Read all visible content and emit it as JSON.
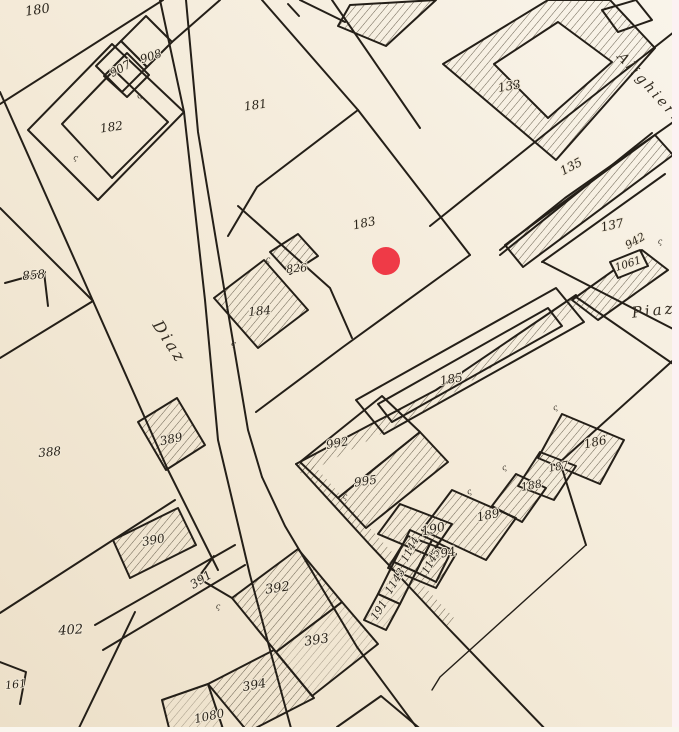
{
  "map": {
    "background": "#f2e9d7",
    "ink": "#241f18",
    "hatch_color": "#5a5140",
    "photo_edge_right_color": "#fcf2f3",
    "photo_edge_bottom_color": "#faf6ee",
    "marker": {
      "x": 386,
      "y": 261,
      "r": 14,
      "color": "#ef3a47"
    },
    "street_labels": [
      {
        "id": "diaz",
        "text": "Diaz",
        "x": 165,
        "y": 345,
        "rotation": 57,
        "size": 16
      },
      {
        "id": "alighieri",
        "text": "Alighieri",
        "x": 646,
        "y": 90,
        "rotation": 48,
        "size": 14
      },
      {
        "id": "piazza",
        "text": "Piaz.",
        "x": 658,
        "y": 315,
        "rotation": -6,
        "size": 15
      }
    ],
    "parcel_labels": [
      {
        "text": "180",
        "x": 38,
        "y": 14,
        "rotation": -8,
        "size": 13
      },
      {
        "text": "907",
        "x": 122,
        "y": 72,
        "rotation": -28,
        "size": 11.5
      },
      {
        "text": "908",
        "x": 152,
        "y": 60,
        "rotation": -18,
        "size": 11.5
      },
      {
        "text": "182",
        "x": 112,
        "y": 131,
        "rotation": -8,
        "size": 12
      },
      {
        "text": "181",
        "x": 256,
        "y": 109,
        "rotation": -8,
        "size": 12
      },
      {
        "text": "133",
        "x": 510,
        "y": 90,
        "rotation": -10,
        "size": 12
      },
      {
        "text": "135",
        "x": 573,
        "y": 170,
        "rotation": -28,
        "size": 12
      },
      {
        "text": "137",
        "x": 613,
        "y": 229,
        "rotation": -12,
        "size": 12
      },
      {
        "text": "942",
        "x": 637,
        "y": 244,
        "rotation": -30,
        "size": 11
      },
      {
        "text": "1061",
        "x": 629,
        "y": 267,
        "rotation": -18,
        "size": 10.5
      },
      {
        "text": "183",
        "x": 365,
        "y": 227,
        "rotation": -12,
        "size": 12
      },
      {
        "text": "826",
        "x": 297,
        "y": 272,
        "rotation": -5,
        "size": 11
      },
      {
        "text": "184",
        "x": 260,
        "y": 315,
        "rotation": -5,
        "size": 12
      },
      {
        "text": "858",
        "x": 34,
        "y": 279,
        "rotation": -5,
        "size": 12
      },
      {
        "text": "388",
        "x": 50,
        "y": 456,
        "rotation": -5,
        "size": 12
      },
      {
        "text": "389",
        "x": 172,
        "y": 443,
        "rotation": -12,
        "size": 12
      },
      {
        "text": "185",
        "x": 452,
        "y": 383,
        "rotation": -10,
        "size": 12
      },
      {
        "text": "992",
        "x": 338,
        "y": 447,
        "rotation": -10,
        "size": 12
      },
      {
        "text": "995",
        "x": 366,
        "y": 485,
        "rotation": -8,
        "size": 12
      },
      {
        "text": "186",
        "x": 596,
        "y": 446,
        "rotation": -12,
        "size": 12
      },
      {
        "text": "187",
        "x": 559,
        "y": 470,
        "rotation": -10,
        "size": 10.5
      },
      {
        "text": "188",
        "x": 532,
        "y": 489,
        "rotation": -10,
        "size": 11
      },
      {
        "text": "189",
        "x": 489,
        "y": 519,
        "rotation": -12,
        "size": 12
      },
      {
        "text": "190",
        "x": 434,
        "y": 533,
        "rotation": -12,
        "size": 12.5
      },
      {
        "text": "994",
        "x": 445,
        "y": 557,
        "rotation": -10,
        "size": 12
      },
      {
        "text": "1144",
        "x": 413,
        "y": 551,
        "rotation": -62,
        "size": 10.5
      },
      {
        "text": "1145",
        "x": 434,
        "y": 563,
        "rotation": -62,
        "size": 10.5
      },
      {
        "text": "1143",
        "x": 398,
        "y": 583,
        "rotation": -58,
        "size": 11
      },
      {
        "text": "191",
        "x": 382,
        "y": 612,
        "rotation": -58,
        "size": 11
      },
      {
        "text": "390",
        "x": 154,
        "y": 544,
        "rotation": -10,
        "size": 12
      },
      {
        "text": "391",
        "x": 203,
        "y": 583,
        "rotation": -32,
        "size": 12
      },
      {
        "text": "402",
        "x": 71,
        "y": 634,
        "rotation": -4,
        "size": 13
      },
      {
        "text": "161",
        "x": 16,
        "y": 688,
        "rotation": -6,
        "size": 11
      },
      {
        "text": "392",
        "x": 278,
        "y": 592,
        "rotation": -8,
        "size": 13
      },
      {
        "text": "393",
        "x": 317,
        "y": 644,
        "rotation": -8,
        "size": 13
      },
      {
        "text": "394",
        "x": 255,
        "y": 689,
        "rotation": -10,
        "size": 12.5
      },
      {
        "text": "1080",
        "x": 210,
        "y": 720,
        "rotation": -12,
        "size": 12
      }
    ],
    "tick_marks": [
      {
        "x": 75,
        "y": 160,
        "rotation": 15
      },
      {
        "x": 140,
        "y": 98,
        "rotation": -25
      },
      {
        "x": 268,
        "y": 262,
        "rotation": 0
      },
      {
        "x": 233,
        "y": 346,
        "rotation": 10
      },
      {
        "x": 345,
        "y": 499,
        "rotation": 0
      },
      {
        "x": 470,
        "y": 494,
        "rotation": -20
      },
      {
        "x": 505,
        "y": 470,
        "rotation": -20
      },
      {
        "x": 218,
        "y": 609,
        "rotation": 0
      },
      {
        "x": 556,
        "y": 410,
        "rotation": -20
      },
      {
        "x": 660,
        "y": 244,
        "rotation": 0
      }
    ]
  }
}
